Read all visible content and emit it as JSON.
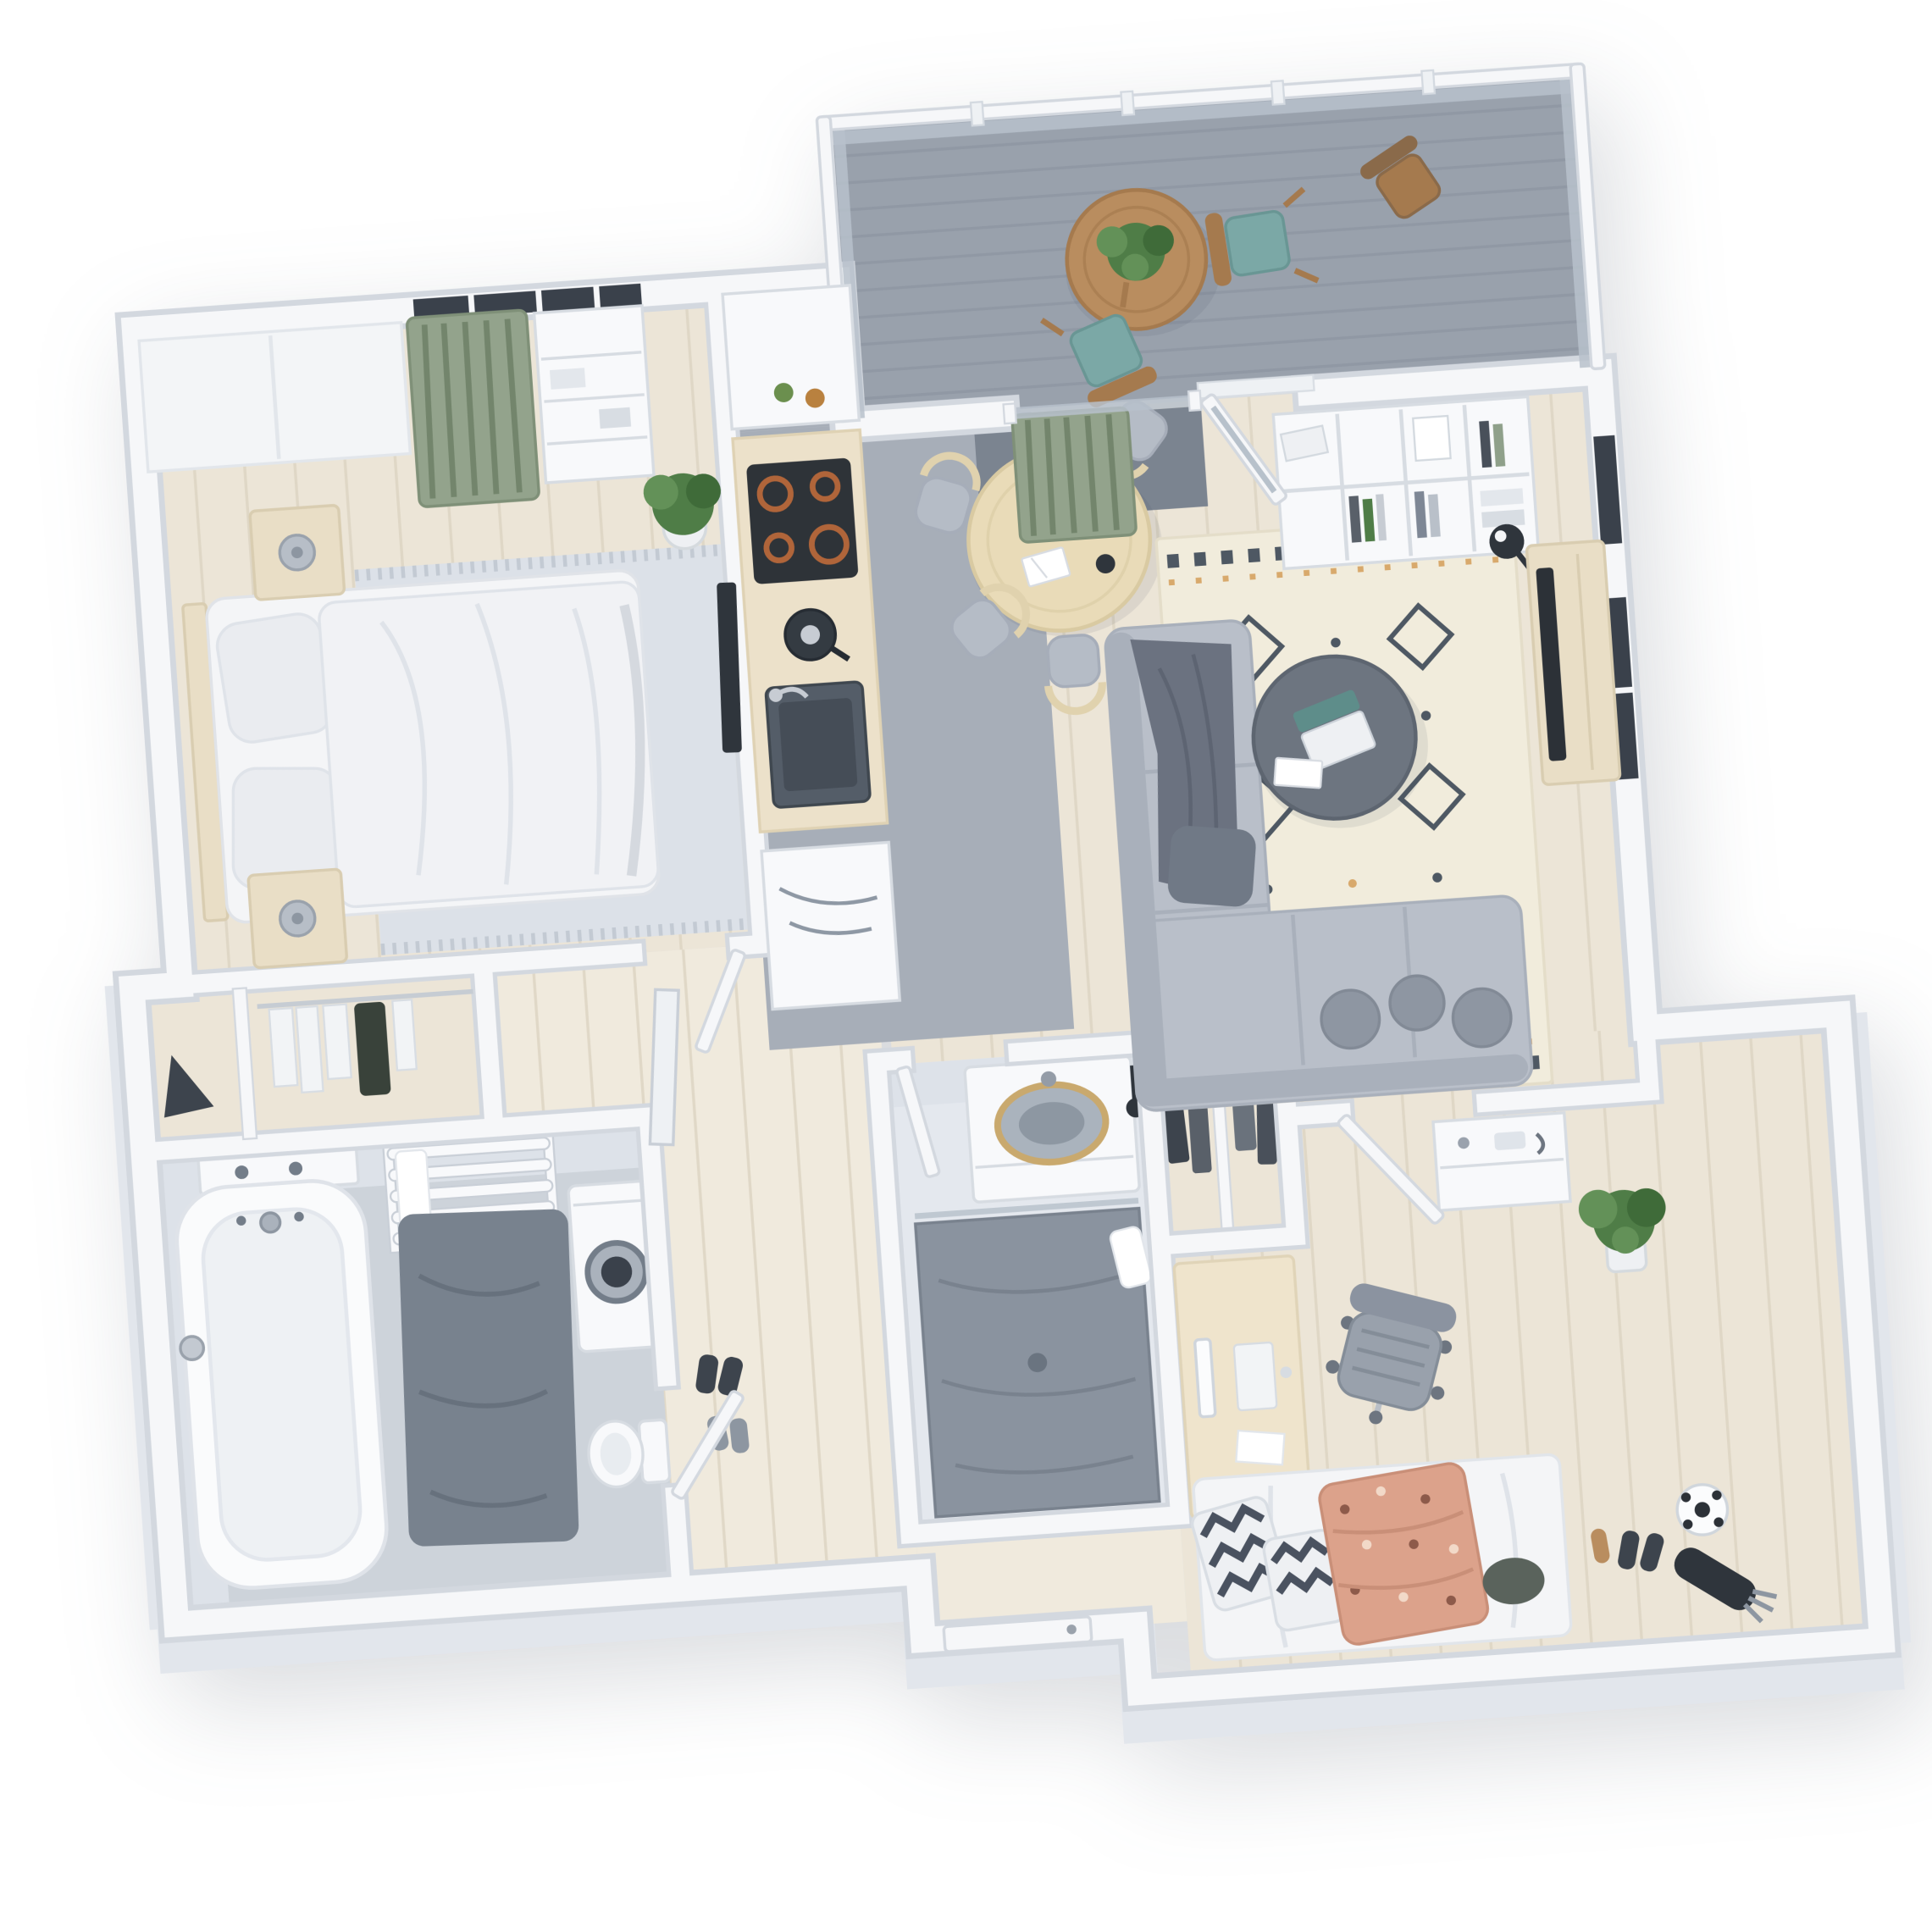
{
  "scene": {
    "description": "3D isometric top-down floor plan render of a furnished two-bedroom apartment with balcony",
    "background": "#ffffff"
  },
  "palette": {
    "bg": "#ffffff",
    "shadow": "rgba(70,80,95,0.20)",
    "wall": "#f6f7f9",
    "wall-edge": "#d3d8df",
    "wall-face": "#e2e6ec",
    "wood": "#ece5d7",
    "wood-line": "#ddd4c2",
    "hall-wood": "#f0eadd",
    "gray-floor": "#a7aeb8",
    "balcony-floor": "#99a1ac",
    "balcony-line": "#8b93a0",
    "mat-dark": "#7b8490",
    "tile-light": "#e4e8ee",
    "tile-band": "#dde2e9",
    "bath-floor": "#cdd3da",
    "shower-floor": "#8a939f",
    "glass": "#b7c1cb",
    "window-dark": "#3a414b",
    "rug-bed": "#dce1e8",
    "rug-bed-fringe": "#c3cad3",
    "rug-living": "#f1ecdc",
    "rug-living-edge": "#e4ddc9",
    "rug-motif": "#4e5863",
    "rug-accent": "#d8a96c",
    "sofa": "#b9bfc9",
    "sofa-dark": "#a9b0bb",
    "pillow": "#8e96a2",
    "pillow-edge": "#828a96",
    "throw": "#6b7280",
    "throw-line": "#5d6472",
    "table-dark": "#6d7580",
    "table-dark-edge": "#5d6570",
    "wood-furn": "#e9dec6",
    "wood-furn-edge": "#d9cdb1",
    "counter-wood": "#ece1ca",
    "counter-wood-edge": "#dfd2b4",
    "stove": "#2e3338",
    "burner": "#b0653a",
    "steel": "#c7ccd3",
    "dark": "#2f353c",
    "appliance": "#f8f9fb",
    "appliance-edge": "#d7dce2",
    "metal-dark": "#737d89",
    "plant": "#4f7d47",
    "plant-light": "#639158",
    "plant-dark": "#3f6b39",
    "pot": "#eef0f3",
    "pot-edge": "#d5dade",
    "curtain": "#93a38c",
    "curtain-edge": "#7f9078",
    "curtain-stripe": "#73856c",
    "teal": "#7ba8a6",
    "teal-edge": "#699694",
    "chair-wood": "#a57a4e",
    "balcony-table": "#b98d5f",
    "duvet": "#f4f5f7",
    "duvet-line": "#dfe3e9",
    "duvet-fold": "#d5d9df",
    "blanket": "#dca28b",
    "blanket-edge": "#c98f78",
    "blanket-dot": "#8d5a4a",
    "blanket-dot-light": "#f2d9c8",
    "chevron": "#4a5260",
    "clothes1": "#3d444d",
    "clothes2": "#596069",
    "clothes3": "#6a727c",
    "clothes4": "#49505a",
    "clothes-white": "#f2f4f6",
    "office-chair": "#99a1ac",
    "office-chair-edge": "#848d98",
    "office-chair-frame": "#b9bfc7",
    "desk-wood": "#efe4cc",
    "desk-wood-edge": "#e0d4b8",
    "seat": "#b5bcc6",
    "seat-edge": "#a6adb9",
    "dining-wood": "#e0d2ae",
    "dining-table": "#e9dbb8",
    "dining-table-edge": "#d9caa2",
    "basin": "#aab3bd",
    "basin-inner": "#8d97a2",
    "basin-rim": "#c9a96e",
    "drain": "#6a7480"
  },
  "rooms": [
    {
      "id": "bedroom",
      "label": "master bedroom",
      "furniture": [
        "double-bed",
        "pillows",
        "duvet",
        "nightstand x2",
        "table-lamp x2",
        "area-rug",
        "wardrobe-front",
        "open-shelf-unit",
        "green-curtain",
        "window",
        "potted-plant",
        "leaning-mirror",
        "walk-in-closet"
      ]
    },
    {
      "id": "kitchen",
      "label": "kitchen",
      "furniture": [
        "counter",
        "upper-cabinet",
        "bottles",
        "cooktop-4-burners",
        "kettle",
        "sink",
        "sideboard-with-artwork"
      ]
    },
    {
      "id": "dining-area",
      "label": "dining area",
      "furniture": [
        "round-table",
        "chair x4",
        "open-book",
        "coffee-cup",
        "centerpiece"
      ]
    },
    {
      "id": "living-room",
      "label": "living room",
      "furniture": [
        "sectional-sofa",
        "throw-blanket",
        "cushions",
        "round-coffee-table",
        "laptop",
        "patterned-area-rug",
        "cube-bookshelf",
        "floor-lamp",
        "tv-console",
        "tv",
        "windows"
      ]
    },
    {
      "id": "balcony",
      "label": "balcony",
      "furniture": [
        "glass-railing",
        "bistro-table",
        "potted-plant",
        "folding-chair x3",
        "open-glass-door",
        "threshold-mat"
      ]
    },
    {
      "id": "bathroom-1",
      "label": "main bathroom",
      "furniture": [
        "bathtub",
        "bath-mat",
        "towel-ladder",
        "towel",
        "washing-machine",
        "vanity-faucets",
        "toilet"
      ]
    },
    {
      "id": "bathroom-2",
      "label": "shower bathroom",
      "furniture": [
        "vanity",
        "oval-sink",
        "shower-floor",
        "toilet-brush",
        "towel"
      ]
    },
    {
      "id": "wardrobe-nook",
      "label": "wardrobe nook",
      "furniture": [
        "hanging-clothes",
        "folded-clothes",
        "divider"
      ]
    },
    {
      "id": "office-bedroom",
      "label": "second bedroom / office",
      "furniture": [
        "desk",
        "monitor",
        "keyboard",
        "office-chair",
        "single-bed",
        "chevron-pillows",
        "patterned-blanket",
        "dark-cushion",
        "soccer-ball",
        "shoes",
        "golf-bag",
        "entry-console",
        "potted-plant"
      ]
    },
    {
      "id": "hallway",
      "label": "hallway",
      "furniture": [
        "leaning-mirror",
        "shoes",
        "entry-door"
      ]
    }
  ]
}
